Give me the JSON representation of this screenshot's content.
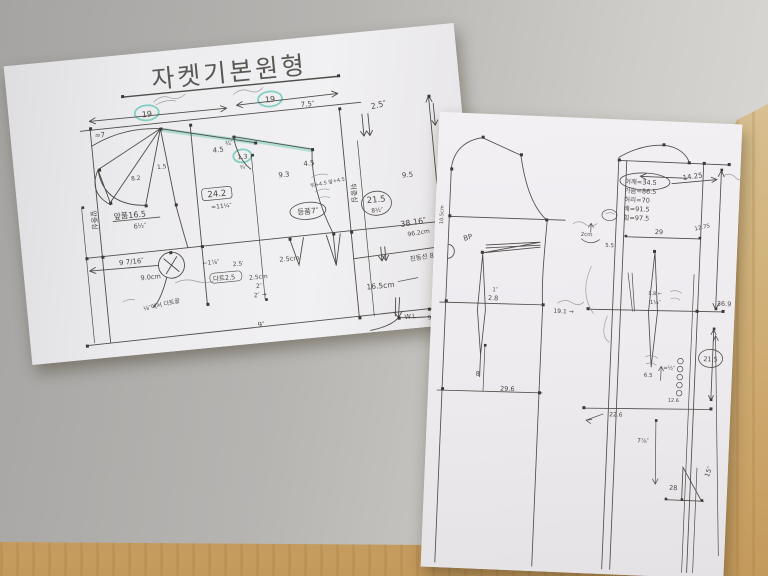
{
  "scene": {
    "wall_color": "#b6b4b1",
    "desk_wood_color": "#c79e61",
    "paper_color": "#edebee",
    "pencil_color": "#4f4d4a",
    "highlight_color": "#7ed0bf"
  },
  "left_sheet": {
    "title": "자켓기본원형",
    "labels": [
      "19",
      "19",
      "7.5″",
      "2.5″",
      "≈7",
      "4.5",
      "¾′",
      "1.3",
      "¾″",
      "4.5",
      "9.3",
      "9.5",
      "8.2",
      "1.5",
      "24.2",
      "≈11¼″",
      "앞품16.5",
      "6½″",
      "9 7/16″",
      "9.0cm",
      "←1⅞″",
      "2.5′",
      "2.5cm",
      "다트2.5",
      "2.5cm",
      "2″",
      "2″ →",
      "등품7″",
      "뒤중심",
      "앞중심",
      "21.5",
      "8½″",
      "38.16″",
      "96.2cm",
      "진동선 8½",
      "16.5cm",
      "W.L",
      "9″",
      "9″ 23cm",
      "⅛″에서 다트끝",
      "뒤+4.5 앞+4.5",
      "9.8인치"
    ]
  },
  "right_sheet": {
    "labels": [
      "BP",
      "10.5cm",
      "1″",
      "2.8",
      "8",
      "29.6",
      "2cm",
      "5.5",
      "19.1 →",
      "어깨=34.5",
      "가슴=86.5",
      "허리=70",
      "배=91.5",
      "힙=97.5",
      "14.25",
      "29",
      "12.75",
      "1.8 ←",
      "1¼″",
      "36.9",
      "21.5",
      "6.5",
      "=½″",
      "22.6",
      "12.6",
      "7⅞″",
      "28",
      "15″"
    ]
  }
}
